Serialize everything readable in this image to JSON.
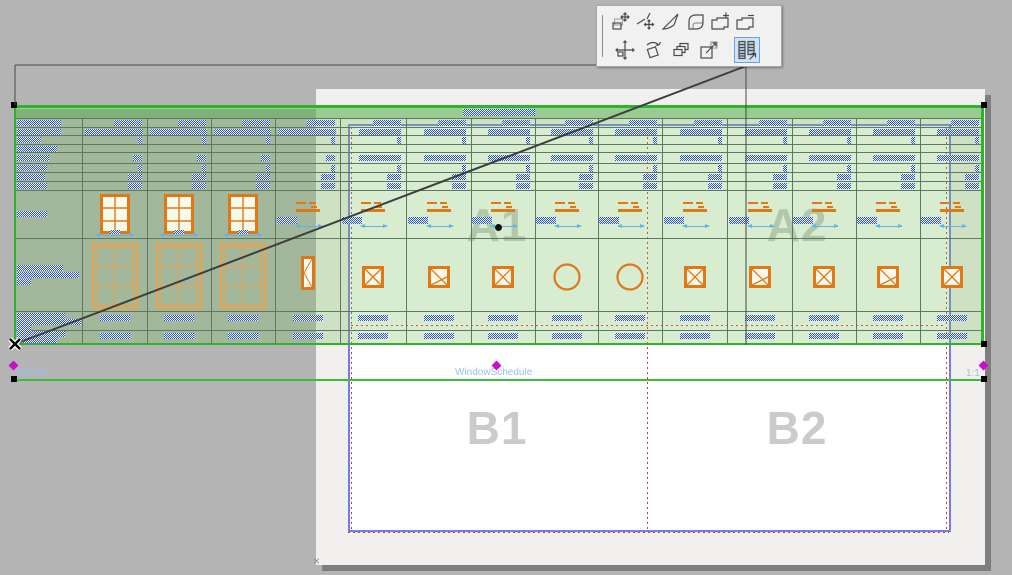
{
  "canvas": {
    "background": "#b4b4b4"
  },
  "pet_palette": {
    "row1": [
      {
        "name": "move-node"
      },
      {
        "name": "move-edge-point"
      },
      {
        "name": "curve-edge"
      },
      {
        "name": "fillet-corner"
      },
      {
        "name": "add-to-polygon"
      },
      {
        "name": "subtract-from-polygon"
      }
    ],
    "row2": [
      {
        "name": "drag"
      },
      {
        "name": "rotate"
      },
      {
        "name": "multiply"
      },
      {
        "name": "resize"
      },
      {
        "name": "split-schedule",
        "active": true
      }
    ],
    "active_highlight_color": "#cfe3f6"
  },
  "layout_sheet": {
    "grid_cells": [
      {
        "label": "A1",
        "cx": 497,
        "cy": 227
      },
      {
        "label": "A2",
        "cx": 797,
        "cy": 227
      },
      {
        "label": "B1",
        "cx": 497,
        "cy": 430
      },
      {
        "label": "B2",
        "cx": 797,
        "cy": 430
      }
    ],
    "corner_marker": "×"
  },
  "drawing": {
    "id_text": "IES-04",
    "title_text": "WindowSchedule",
    "scale_text": "1:1"
  },
  "colors": {
    "selection_green": "#2fb32f",
    "title_line_green": "#3bbd3b",
    "grid_line": "#5c7a60",
    "greek_blue": "#2a4fc4",
    "symbol_orange": "#e07818",
    "big_window_orange": "#efa049",
    "dimension_blue": "#63b3e8",
    "frame_blue": "#6f7fe6",
    "guide_red": "#e03030",
    "hotspot_magenta": "#c810c8"
  },
  "schedule_spec": {
    "x": 14,
    "y": 105,
    "w": 970,
    "h": 240,
    "col_edges": [
      0,
      68,
      133,
      197,
      261,
      326,
      392,
      457,
      521,
      584,
      648,
      713,
      778,
      842,
      906,
      970
    ],
    "row_lines": [
      13,
      22,
      30,
      39,
      47,
      58,
      67,
      76,
      85,
      133,
      206,
      225
    ],
    "title_hatch": [
      449,
      4,
      72,
      7
    ],
    "col1_hatches": [
      [
        3,
        15,
        44,
        6
      ],
      [
        3,
        24,
        44,
        6
      ],
      [
        3,
        32,
        24,
        6
      ],
      [
        3,
        41,
        40,
        6
      ],
      [
        3,
        50,
        32,
        6
      ],
      [
        3,
        60,
        30,
        6
      ],
      [
        3,
        69,
        28,
        6
      ],
      [
        3,
        78,
        30,
        6
      ],
      [
        3,
        106,
        30,
        6
      ],
      [
        3,
        160,
        46,
        6
      ],
      [
        3,
        167,
        62,
        6
      ],
      [
        3,
        174,
        14,
        6
      ],
      [
        3,
        208,
        48,
        6
      ],
      [
        3,
        214,
        64,
        6
      ],
      [
        3,
        220,
        14,
        6
      ],
      [
        3,
        226,
        48,
        6
      ],
      [
        3,
        232,
        40,
        6
      ]
    ],
    "rowB_symbols": [
      "sqx",
      "sqd",
      "sqx",
      "cir",
      "cir",
      "sqx",
      "sqd",
      "sqx",
      "sqd",
      "sqx"
    ]
  },
  "drag_feedback": {
    "ghost_rect": {
      "x1": 15,
      "y1": 65,
      "x2": 746,
      "y2": 345
    },
    "drag_line": {
      "x1": 15,
      "y1": 344,
      "x2": 746,
      "y2": 66
    },
    "origin_marker": {
      "x": 15,
      "y": 344
    }
  }
}
